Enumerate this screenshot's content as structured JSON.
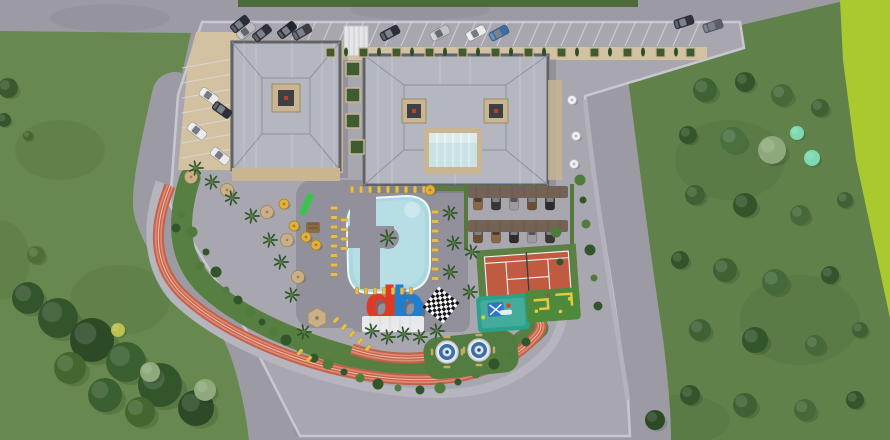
{
  "scene": {
    "type": "aerial-3d-site-plan",
    "subject": "residential complex master plan with amenities, top-down render"
  },
  "logo": {
    "letter_d": "d",
    "letter_b": "b",
    "d_color": "#df3a28",
    "b_color": "#1d7fd2"
  },
  "amenities": [
    "swimming-pool",
    "pool-island-palm",
    "sun-lounger-terraces",
    "jogging-track",
    "tennis-court",
    "giant-chessboard",
    "children-playground",
    "mini-golf",
    "gazebo",
    "mosaic-fountain-plazas",
    "covered-parking",
    "guest-parking",
    "landscaped-gardens",
    "db-logo-sculpture",
    "glass-atrium-entrance"
  ],
  "counts": {
    "buildings": 2,
    "roof_skylights": 3,
    "cars": 25,
    "carport_cars": 10,
    "sun_loungers": 43,
    "umbrellas": 12,
    "palm_trees": 19,
    "trees": 42,
    "shrubs": 34,
    "fountain_circles": 2,
    "gazebos": 1
  },
  "palette": {
    "road": "#9c9ba4",
    "plaza": "#a8a7b0",
    "wall": "#c9c8d0",
    "lawn": "#67884e",
    "field": "#60814a",
    "bright": "#a9c92e",
    "topstrip": "#4c6a3a",
    "deck": "#92919b",
    "water": "#abd8de",
    "waterlight": "#c6e7ea",
    "track": "#c2614c",
    "tracklight": "#e08a70",
    "tennis": "#c05a41",
    "apron": "#5c8043",
    "tan": "#d2c2a1",
    "trim": "#c9b592",
    "roof": "#b4b7c0",
    "roofedge": "#5f626a",
    "glass": "#c9e2e3",
    "lounger": "#e5bf4e",
    "umbrella": "#c9b089",
    "carport": "#746355",
    "teal": "#2aa18c",
    "golf": "#4d8a3b",
    "fountain": "#3a6fa8",
    "dred": "#df3a28",
    "dblue": "#1d7fd2",
    "palm": "#2f5429",
    "bush": "#33552b",
    "bush2": "#517b3c",
    "sage": "#8fa97c",
    "mint": "#7cd9b2",
    "ylw": "#e6c93e"
  }
}
